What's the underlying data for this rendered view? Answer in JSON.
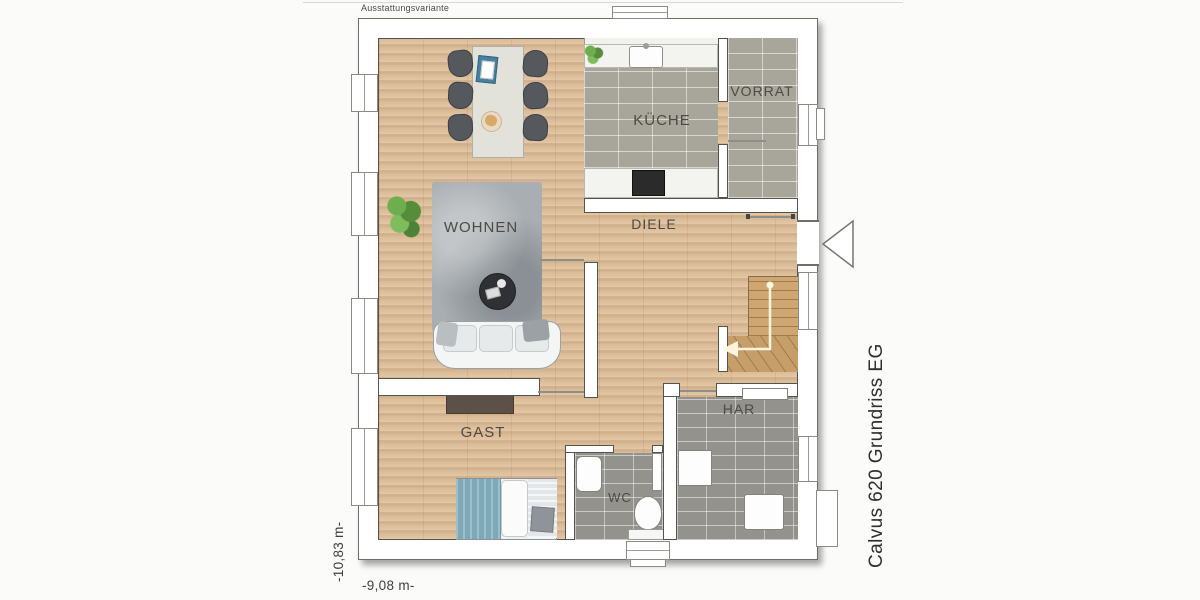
{
  "header": {
    "variant_label": "Ausstattungsvariante"
  },
  "title": {
    "side_label": "Calvus 620 Grundriss EG"
  },
  "dimensions": {
    "width_label": "-9,08 m-",
    "depth_label": "-10,83 m-"
  },
  "rooms": {
    "kueche": "KÜCHE",
    "vorrat": "VORRAT",
    "diele": "DIELE",
    "wohnen": "WOHNEN",
    "gast": "GAST",
    "wc": "WC",
    "har": "HAR"
  },
  "colors": {
    "wood_floor": "#dcc0a0",
    "kitchen_tile": "#a8a59b",
    "bath_tile": "#94928c",
    "wall_fill": "#ffffff",
    "wall_outline": "#54534c",
    "rug": "#a9aeb2",
    "bed_blanket": "#7ea9b9",
    "stair_wood": "#cda671",
    "label_text": "#4c4a42"
  },
  "icons": {
    "entrance_marker": "left-pointing-triangle",
    "stair_arrow": "up-then-left-arrow"
  }
}
